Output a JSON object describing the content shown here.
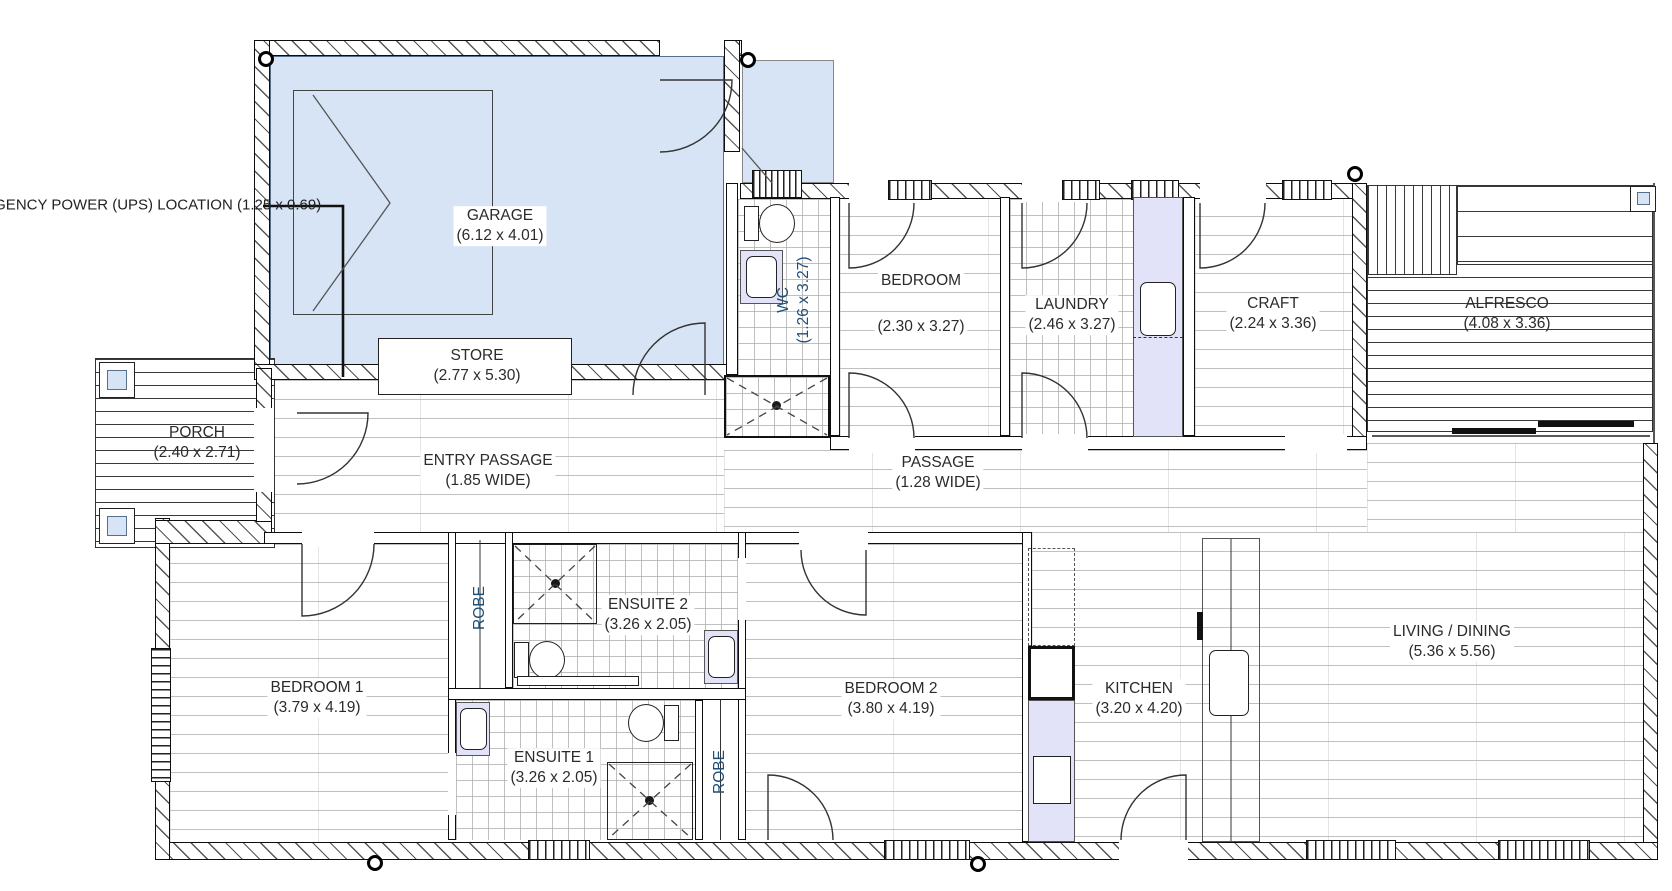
{
  "annotation": {
    "line1": "EMERGENCY POWER (UPS)",
    "line2": "LOCATION",
    "dims": "(1.25 x 0.69)"
  },
  "rooms": {
    "garage": {
      "name": "GARAGE",
      "dims": "(6.12 x 4.01)"
    },
    "store": {
      "name": "STORE",
      "dims": "(2.77 x 5.30)"
    },
    "wc": {
      "name": "WC",
      "dims": "(1.26 x 3.27)"
    },
    "bedroom": {
      "name": "BEDROOM",
      "dims": "(2.30 x 3.27)"
    },
    "laundry": {
      "name": "LAUNDRY",
      "dims": "(2.46 x 3.27)"
    },
    "craft": {
      "name": "CRAFT",
      "dims": "(2.24 x 3.36)"
    },
    "alfresco": {
      "name": "ALFRESCO",
      "dims": "(4.08 x 3.36)"
    },
    "porch": {
      "name": "PORCH",
      "dims": "(2.40 x 2.71)"
    },
    "entry_passage": {
      "name": "ENTRY PASSAGE",
      "dims": "(1.85 WIDE)"
    },
    "passage": {
      "name": "PASSAGE",
      "dims": "(1.28 WIDE)"
    },
    "bedroom1": {
      "name": "BEDROOM 1",
      "dims": "(3.79 x 4.19)"
    },
    "bedroom2": {
      "name": "BEDROOM 2",
      "dims": "(3.80 x 4.19)"
    },
    "ensuite1": {
      "name": "ENSUITE 1",
      "dims": "(3.26 x 2.05)"
    },
    "ensuite2": {
      "name": "ENSUITE 2",
      "dims": "(3.26 x 2.05)"
    },
    "kitchen": {
      "name": "KITCHEN",
      "dims": "(3.20 x 4.20)"
    },
    "living_dining": {
      "name": "LIVING / DINING",
      "dims": "(5.36 x 5.56)"
    },
    "robe1": {
      "name": "ROBE"
    },
    "robe2": {
      "name": "ROBE"
    }
  },
  "colors": {
    "room_fill_blue": "#d7e4f5",
    "bench_lavender": "#e2e2f8",
    "vertical_label_navy": "#1f4e79",
    "label_text": "#2b2b2b"
  }
}
